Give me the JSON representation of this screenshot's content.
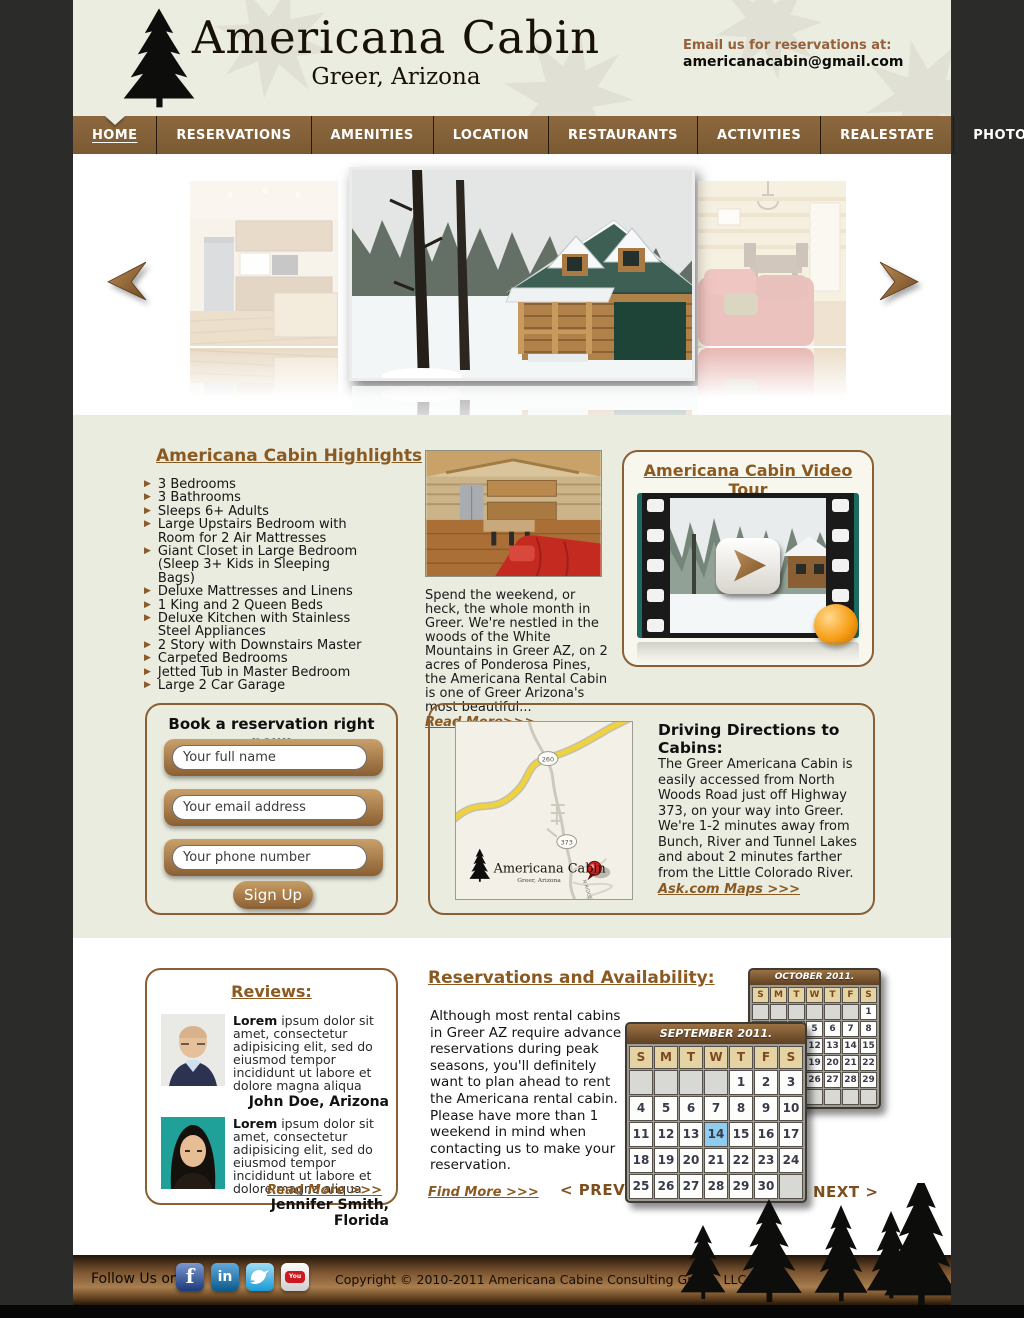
{
  "header": {
    "logo_title": "Americana Cabin",
    "logo_subtitle": "Greer, Arizona",
    "email_label": "Email us for reservations at:",
    "email": "americanacabin@gmail.com"
  },
  "nav": {
    "items": [
      {
        "label": "HOME",
        "active": true
      },
      {
        "label": "RESERVATIONS",
        "active": false
      },
      {
        "label": "AMENITIES",
        "active": false
      },
      {
        "label": "LOCATION",
        "active": false
      },
      {
        "label": "RESTAURANTS",
        "active": false
      },
      {
        "label": "ACTIVITIES",
        "active": false
      },
      {
        "label": "REALESTATE",
        "active": false
      },
      {
        "label": "PHOTO ALBUM",
        "active": false
      }
    ]
  },
  "carousel": {
    "images": [
      "kitchen-photo",
      "snowy-cabin-exterior-photo",
      "living-room-photo"
    ],
    "prev_arrow": "left-arrow",
    "next_arrow": "right-arrow"
  },
  "highlights": {
    "title": "Americana Cabin Highlights",
    "items": [
      "3 Bedrooms",
      "3 Bathrooms",
      "Sleeps 6+ Adults",
      "Large Upstairs Bedroom with Room for 2 Air Mattresses",
      "Giant Closet in Large Bedroom (Sleep 3+ Kids in Sleeping Bags)",
      "Deluxe Mattresses and Linens",
      "1 King and 2 Queen Beds",
      "Deluxe Kitchen with Stainless Steel Appliances",
      "2 Story with Downstairs Master",
      "Carpeted Bedrooms",
      "Jetted Tub in Master Bedroom",
      "Large 2 Car Garage"
    ]
  },
  "intro": {
    "text": "Spend the weekend, or heck, the whole month in Greer. We're nestled in the woods of the White Mountains in Greer AZ, on 2 acres of Ponderosa Pines, the Americana Rental Cabin is one of Greer Arizona's most beautiful...",
    "read_more": "Read More>>>"
  },
  "video_tour": {
    "title": "Americana Cabin Video Tour"
  },
  "reservation_form": {
    "title": "Book a reservation right now:",
    "name_placeholder": "Your full name",
    "email_placeholder": "Your email address",
    "phone_placeholder": "Your phone number",
    "submit_label": "Sign Up"
  },
  "directions": {
    "title": "Driving Directions to Cabins:",
    "body": "The Greer Americana Cabin is easily accessed from North Woods Road just off Highway 373, on your way into Greer. We're 1-2 minutes away from Bunch, River and Tunnel Lakes and about 2 minutes farther from the Little Colorado River.",
    "link": "Ask.com Maps >>>",
    "map": {
      "shield_1": "260",
      "shield_2": "373",
      "logo_title": "Americana Cabin",
      "logo_subtitle": "Greer, Arizona",
      "road_label": "N RIDGE"
    }
  },
  "reviews": {
    "title": "Reviews:",
    "read_more": "Read More >>>",
    "items": [
      {
        "lead": "Lorem",
        "text": " ipsum dolor sit amet, consectetur adipisicing elit, sed do eiusmod tempor incididunt ut labore et dolore magna aliqua",
        "author": "John Doe, Arizona"
      },
      {
        "lead": "Lorem",
        "text": " ipsum dolor sit amet, consectetur adipisicing elit, sed do eiusmod tempor incididunt ut labore et dolore magna aliqua",
        "author": "Jennifer Smith, Florida"
      }
    ]
  },
  "availability": {
    "title": "Reservations and Availability:",
    "body": "Although most rental cabins in Greer AZ require advance reservations during peak seasons, you'll definitely want to plan ahead to rent the Americana rental cabin. Please have more than 1 weekend in mind when contacting us to make your reservation.",
    "find_more": "Find More >>>",
    "prev_label": "< PREV",
    "next_label": "NEXT >",
    "calendars": [
      {
        "title": "OCTOBER 2011.",
        "day_headers": [
          "S",
          "M",
          "T",
          "W",
          "T",
          "F",
          "S"
        ],
        "weeks": [
          [
            "",
            "",
            "",
            "",
            "",
            "",
            "1"
          ],
          [
            "2",
            "3",
            "4",
            "5",
            "6",
            "7",
            "8"
          ],
          [
            "9",
            "10",
            "11",
            "12",
            "13",
            "14",
            "15"
          ],
          [
            "16",
            "17",
            "18",
            "19",
            "20",
            "21",
            "22"
          ],
          [
            "23",
            "24",
            "25",
            "26",
            "27",
            "28",
            "29"
          ],
          [
            "30",
            "31",
            "",
            "",
            "",
            "",
            ""
          ]
        ],
        "selected_day": ""
      },
      {
        "title": "SEPTEMBER 2011.",
        "day_headers": [
          "S",
          "M",
          "T",
          "W",
          "T",
          "F",
          "S"
        ],
        "weeks": [
          [
            "",
            "",
            "",
            "",
            "1",
            "2",
            "3"
          ],
          [
            "4",
            "5",
            "6",
            "7",
            "8",
            "9",
            "10"
          ],
          [
            "11",
            "12",
            "13",
            "14",
            "15",
            "16",
            "17"
          ],
          [
            "18",
            "19",
            "20",
            "21",
            "22",
            "23",
            "24"
          ],
          [
            "25",
            "26",
            "27",
            "28",
            "29",
            "30",
            ""
          ]
        ],
        "selected_day": "14"
      }
    ]
  },
  "footer": {
    "follow_label": "Follow Us on:",
    "social": [
      "facebook",
      "linkedin",
      "twitter",
      "youtube"
    ],
    "copyright": "Copyright © 2010-2011 Americana Cabine Consulting Group, LLC."
  },
  "colors": {
    "accent_brown": "#8a5a22",
    "nav_brown": "#7d5b35",
    "header_cream": "#ecede1",
    "band_cream": "#eaece0",
    "side_background": "#2b2b29",
    "selected_day_blue": "#8ecdef",
    "calendar_header_tan": "#e6d3a4",
    "footer_gold": "#a97e4f"
  }
}
